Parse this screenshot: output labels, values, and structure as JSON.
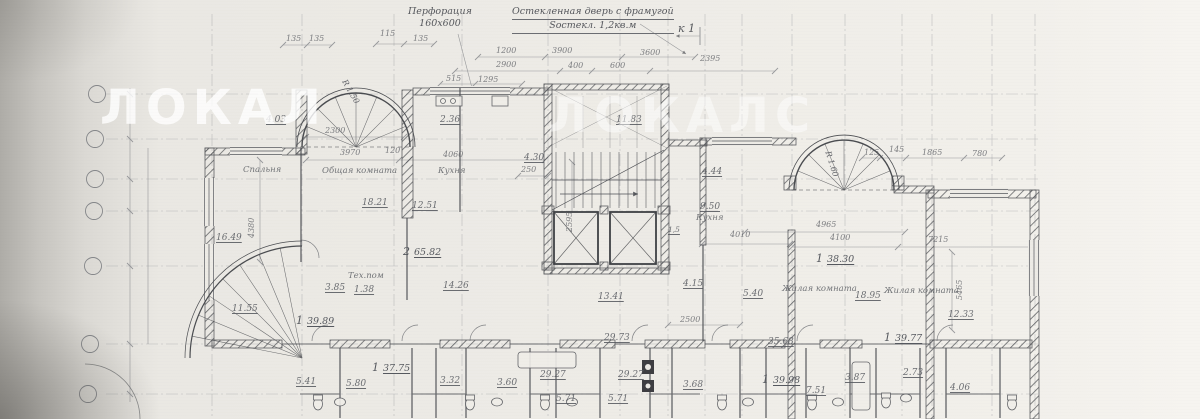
{
  "watermark": {
    "tile1": "ЛОКАЛ",
    "tile2": "ЛОКАЛС"
  },
  "annotations": {
    "perforation_line1": "Перфорация",
    "perforation_line2": "160х600",
    "glazed_door_line1": "Остекленная дверь с фрамугой",
    "glazed_door_line2": "Sостекл. 1,2кв.м",
    "section_marker": "к 1",
    "radius_left": "R 1.50",
    "radius_right": "R 1.60"
  },
  "rooms": [
    "Спальня",
    "Общая комната",
    "Кухня",
    "Кухня",
    "Тех.пом",
    "Жилая комната",
    "Жилая комната"
  ],
  "apartments": [
    {
      "num": "2",
      "area": "65.82"
    },
    {
      "num": "1",
      "area": "39.89"
    },
    {
      "num": "1",
      "area": "38.30"
    },
    {
      "num": "1",
      "area": "39.77"
    },
    {
      "num": "1",
      "area": "37.75"
    },
    {
      "num": "1",
      "area": "39.98"
    }
  ],
  "areas": [
    "4.03",
    "2.36",
    "11.83",
    "4.30",
    "16.49",
    "18.21",
    "12.51",
    "4.44",
    "9.50",
    "1,5",
    "14.26",
    "3.85",
    "1.38",
    "13.41",
    "4.15",
    "5.40",
    "11.55",
    "29.73",
    "35.68",
    "18.95",
    "12.33",
    "5.41",
    "5.80",
    "3.32",
    "3.60",
    "29.27",
    "29.27",
    "3.68",
    "5.71",
    "5.71",
    "3.87",
    "2.73",
    "4.06",
    "7.51"
  ],
  "dims": [
    "2300",
    "3970",
    "120",
    "4060",
    "4380",
    "250",
    "2595",
    "1200",
    "3900",
    "3600",
    "2900",
    "515",
    "1295",
    "400",
    "600",
    "2395",
    "135",
    "135",
    "115",
    "135",
    "125",
    "145",
    "1865",
    "780",
    "4965",
    "4100",
    "7215",
    "4010",
    "5465",
    "2500"
  ]
}
